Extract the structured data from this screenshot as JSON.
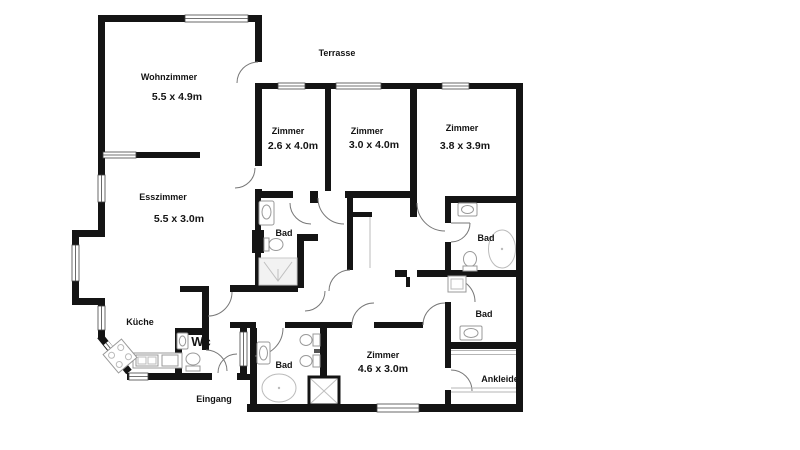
{
  "plan": {
    "colors": {
      "wall": "#141414",
      "window_frame": "#444444",
      "door_arc": "#777777",
      "fixture": "#999999",
      "label": "#141414",
      "background": "#ffffff"
    },
    "outdoor": {
      "terrasse": "Terrasse",
      "eingang": "Eingang"
    },
    "rooms": [
      {
        "name": "Wohnzimmer",
        "dims": "5.5 x 4.9m"
      },
      {
        "name": "Esszimmer",
        "dims": "5.5 x 3.0m"
      },
      {
        "name": "Zimmer",
        "dims": "2.6 x 4.0m"
      },
      {
        "name": "Zimmer",
        "dims": "3.0 x 4.0m"
      },
      {
        "name": "Zimmer",
        "dims": "3.8 x 3.9m"
      },
      {
        "name": "Zimmer",
        "dims": "4.6 x 3.0m"
      },
      {
        "name": "Küche"
      },
      {
        "name": "Wc"
      },
      {
        "name": "Bad"
      },
      {
        "name": "Bad"
      },
      {
        "name": "Bad"
      },
      {
        "name": "Bad"
      },
      {
        "name": "Ankleide"
      }
    ]
  }
}
